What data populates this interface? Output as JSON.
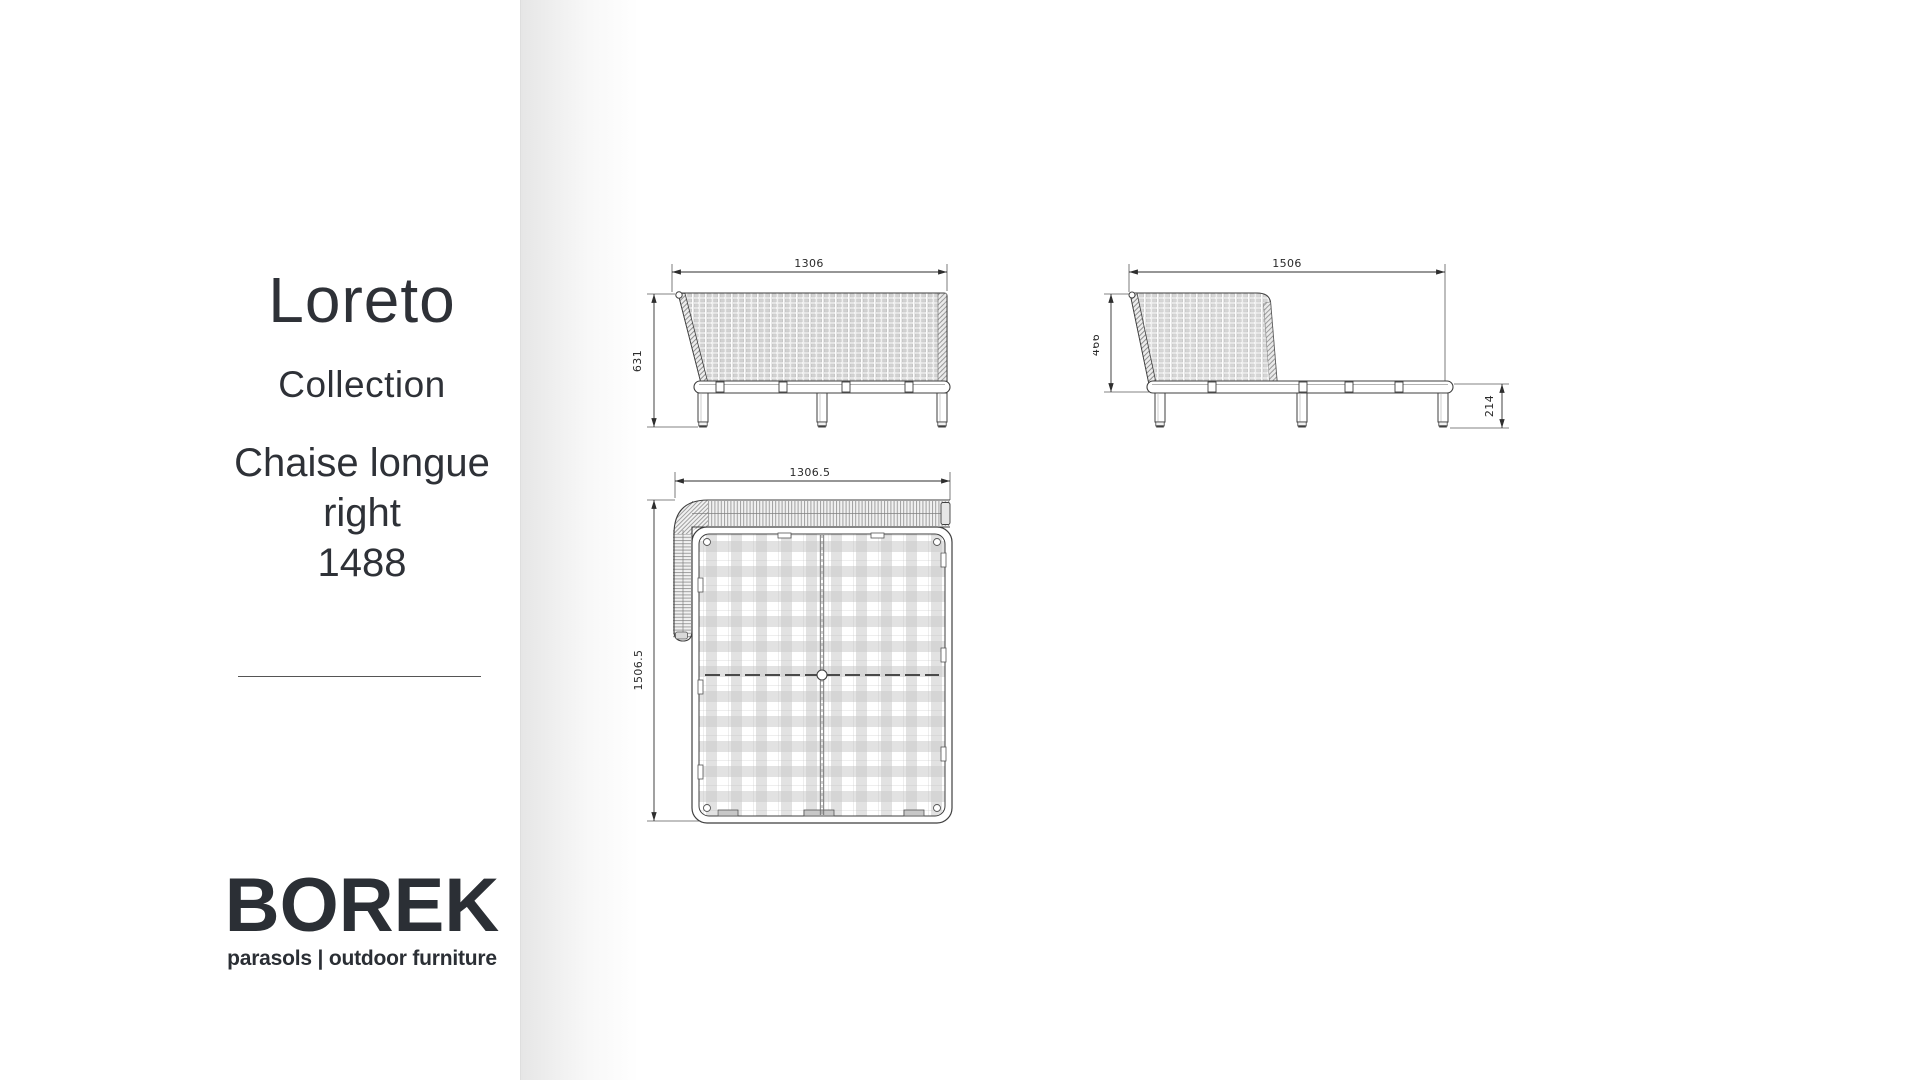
{
  "panel": {
    "title": "Loreto",
    "subtitle": "Collection",
    "product": {
      "line1": "Chaise longue",
      "line2": "right",
      "code": "1488"
    },
    "logo": {
      "brand": "BOREK",
      "tagline": "parasols | outdoor furniture"
    }
  },
  "drawings": {
    "front_view": {
      "width_mm": "1306",
      "height_mm": "631"
    },
    "side_view": {
      "width_mm": "1506",
      "back_height_mm": "466",
      "leg_height_mm": "214"
    },
    "top_view": {
      "width_mm": "1306.5",
      "depth_mm": "1506.5"
    }
  },
  "colors": {
    "text": "#2e3137",
    "drawing_line": "#3f3f3f",
    "divider_shadow": "#e8e8e8",
    "background": "#ffffff"
  }
}
